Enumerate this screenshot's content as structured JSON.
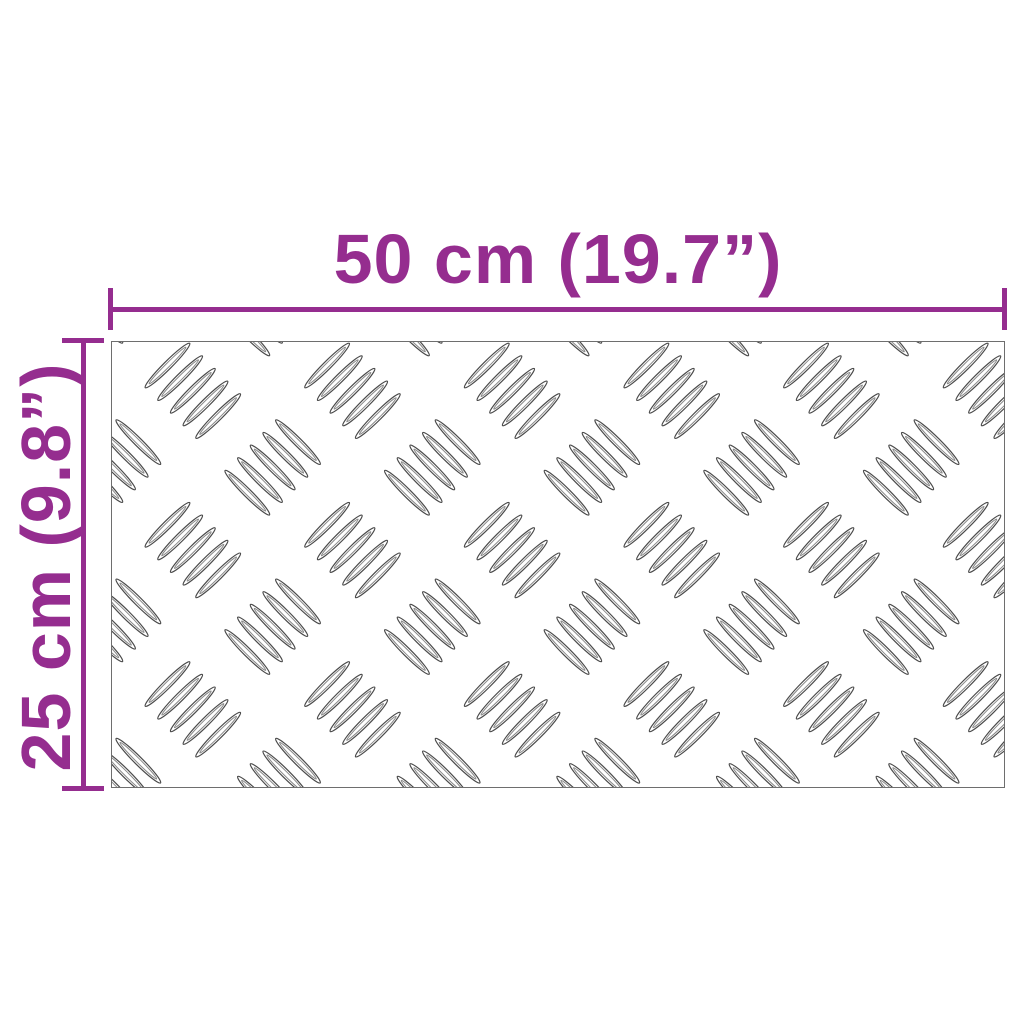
{
  "diagram": {
    "type": "product-dimension-drawing",
    "width_label": "50 cm (19.7”)",
    "height_label": "25 cm (9.8”)"
  },
  "plate": {
    "pattern": "aluminium-checker-5bar",
    "ellipses_per_group": 5
  },
  "colors": {
    "background": "#ffffff",
    "dimension_accent": "#952d8f",
    "plate_border": "#6e6e6e",
    "tread_stroke_outer": "#4a4a4a",
    "tread_stroke_inner": "#8a8a8a"
  }
}
